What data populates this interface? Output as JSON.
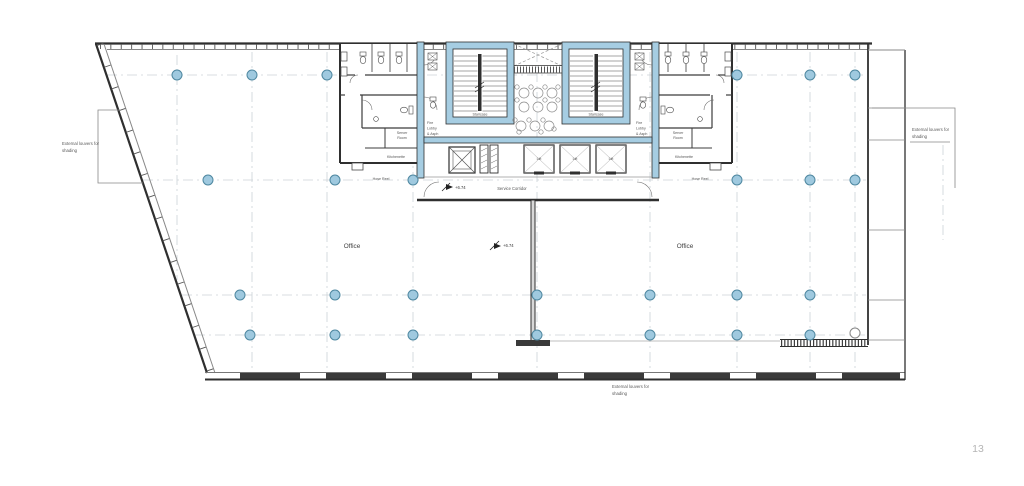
{
  "document": {
    "type": "architectural-floor-plan",
    "page_number": "13"
  },
  "colors": {
    "background": "#ffffff",
    "core_wall_fill": "#a6cde2",
    "column_fill": "#9fc9df",
    "column_stroke": "#4e87a0",
    "wall": "#2f2f2f",
    "grid_line": "#ccd3d8",
    "label_text": "#555555",
    "page_number_text": "#b5b5b5"
  },
  "labels": {
    "staircase": "Staircase",
    "fire_lobby": [
      "Fire",
      "Lobby",
      "& Asph"
    ],
    "service_corridor": "Service Corridor",
    "office": "Office",
    "lift": "Lift",
    "server_room": [
      "Server",
      "Room"
    ],
    "kitchenette": "Kitchenette",
    "hose_reel": "Hose Reel",
    "level": "+6.74",
    "louver_note": [
      "External louvers for",
      "shading"
    ],
    "page_number": "13"
  }
}
